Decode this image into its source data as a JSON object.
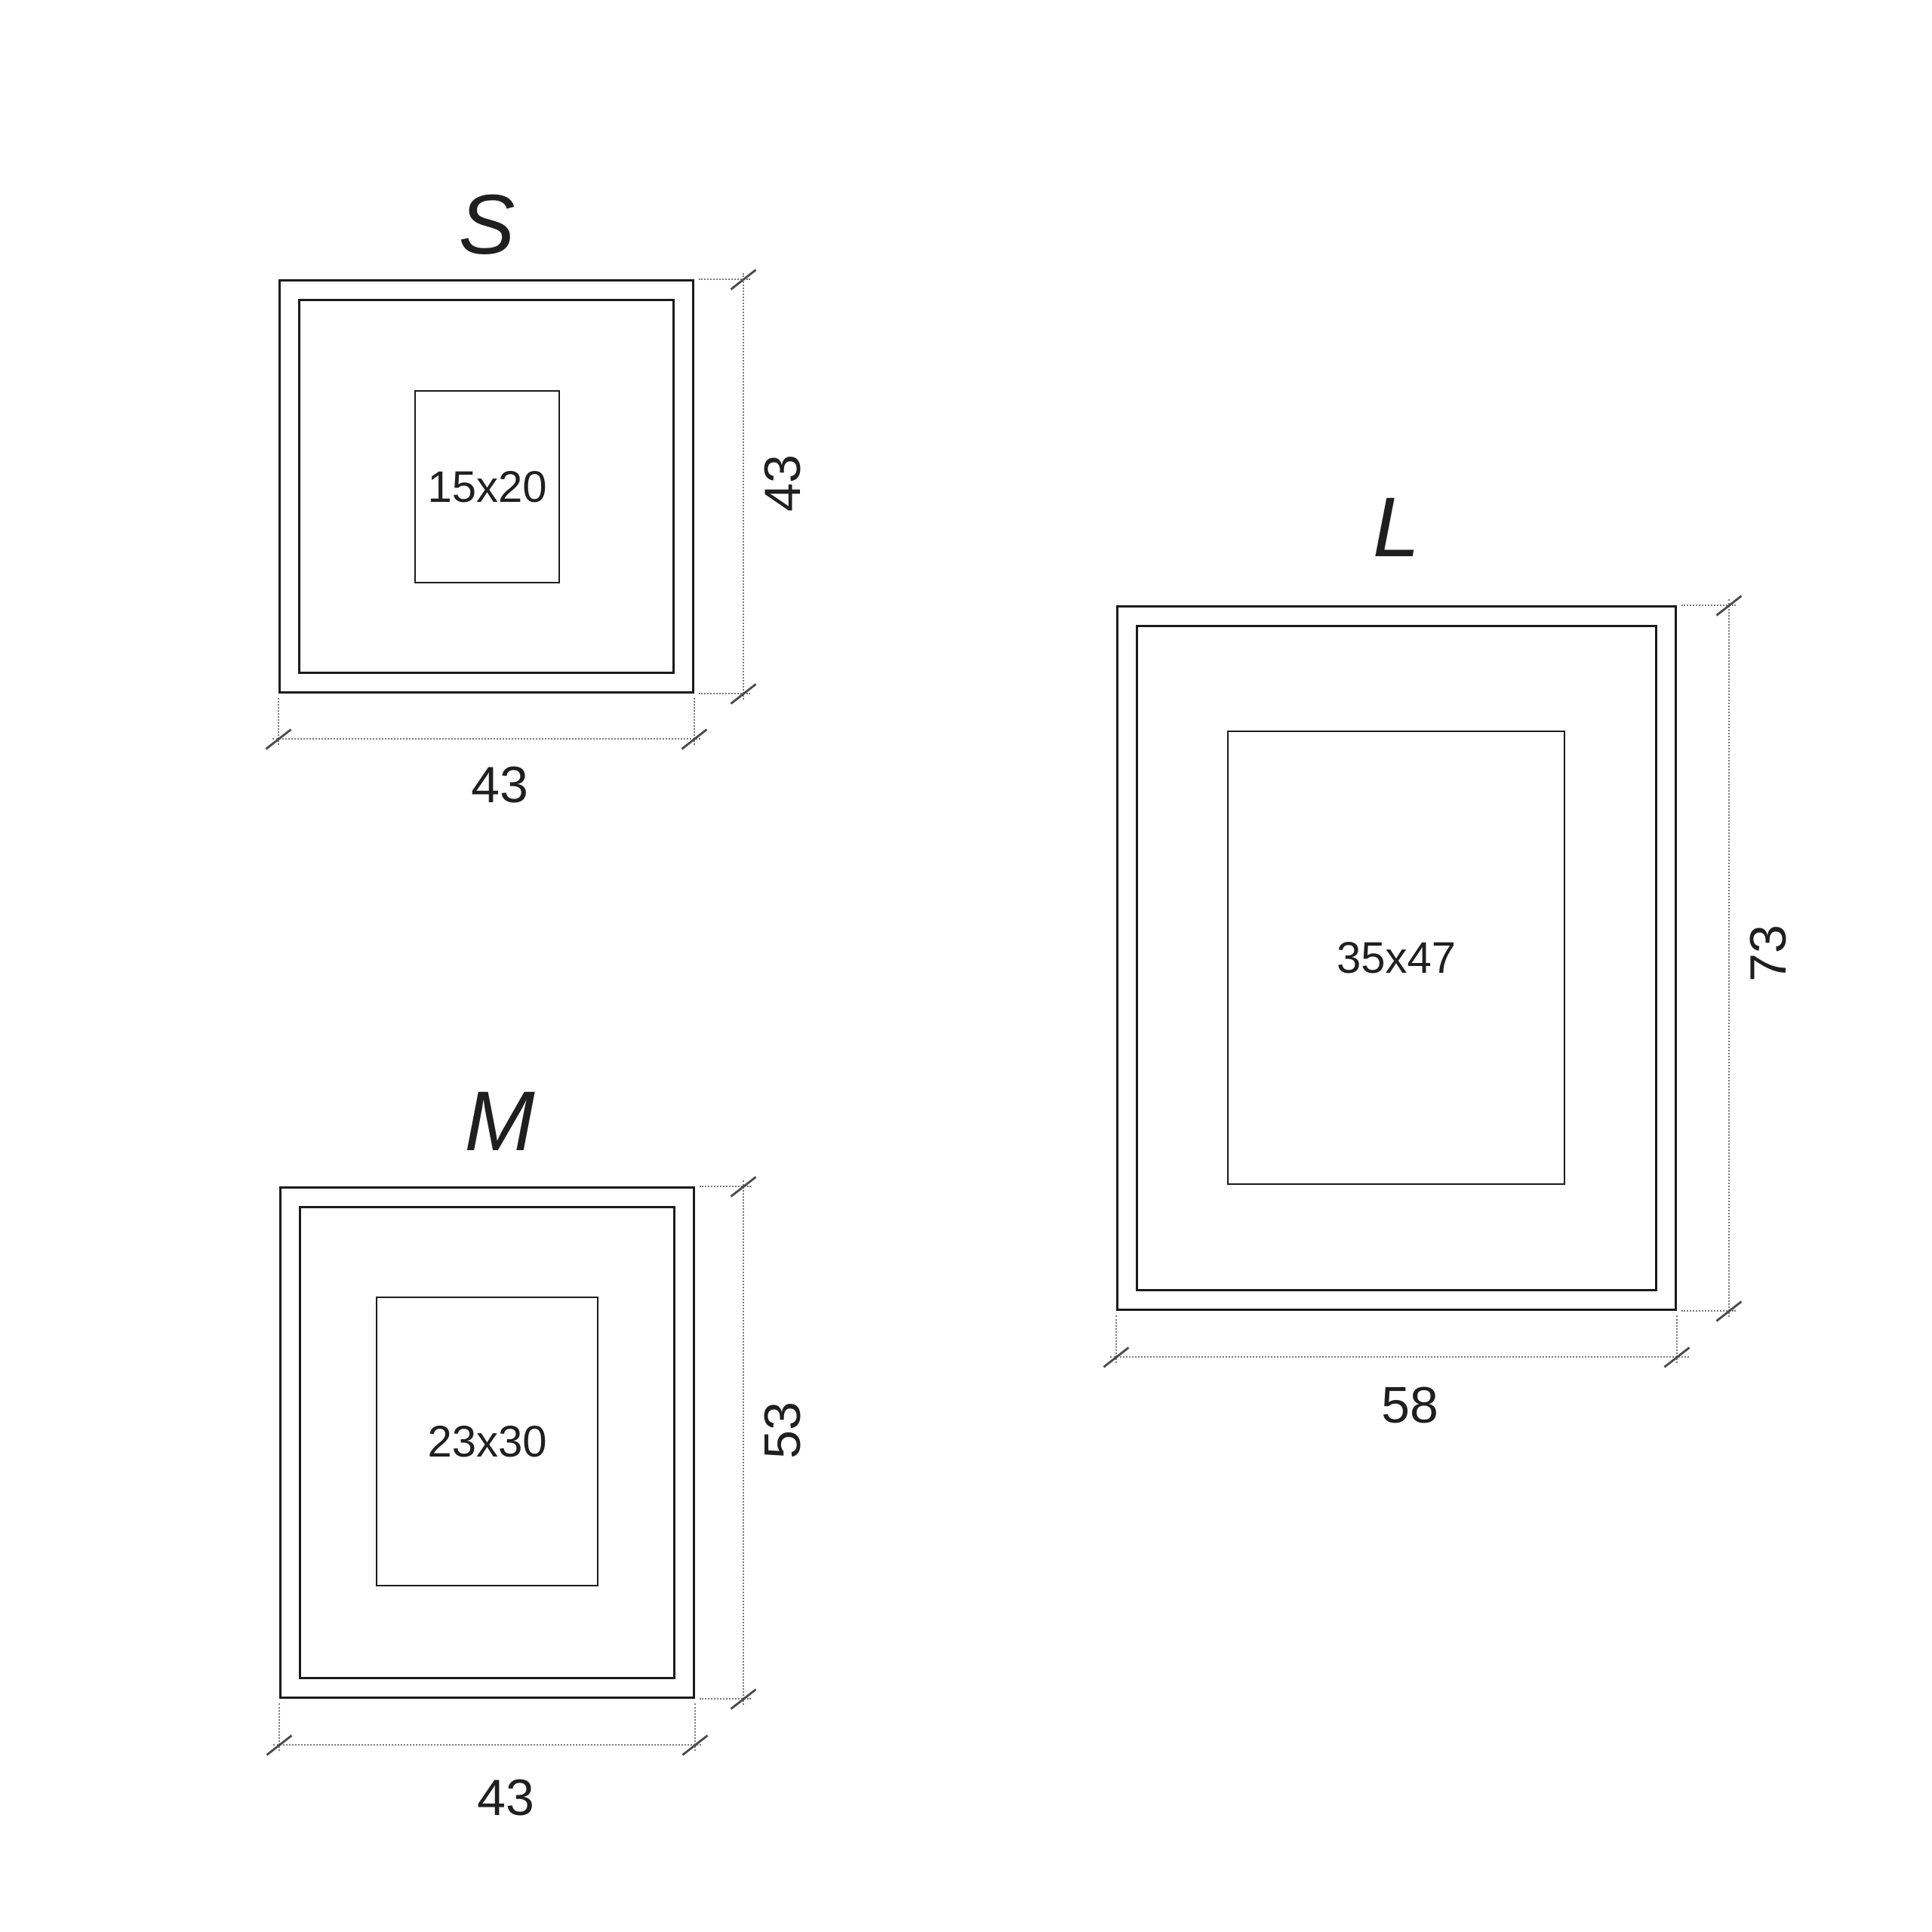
{
  "page": {
    "background": "#ffffff",
    "description_colors": {
      "frame_line": "#1b1b1b",
      "dotted_dimension_line": "#7a7a7a",
      "tick_mark": "#4a4a4a",
      "text": "#1f1f1f"
    }
  },
  "frames": [
    {
      "id": "s",
      "label": "S",
      "opening_label": "15x20",
      "width_label": "43",
      "height_label": "43"
    },
    {
      "id": "m",
      "label": "M",
      "opening_label": "23x30",
      "width_label": "43",
      "height_label": "53"
    },
    {
      "id": "l",
      "label": "L",
      "opening_label": "35x47",
      "width_label": "58",
      "height_label": "73"
    }
  ]
}
